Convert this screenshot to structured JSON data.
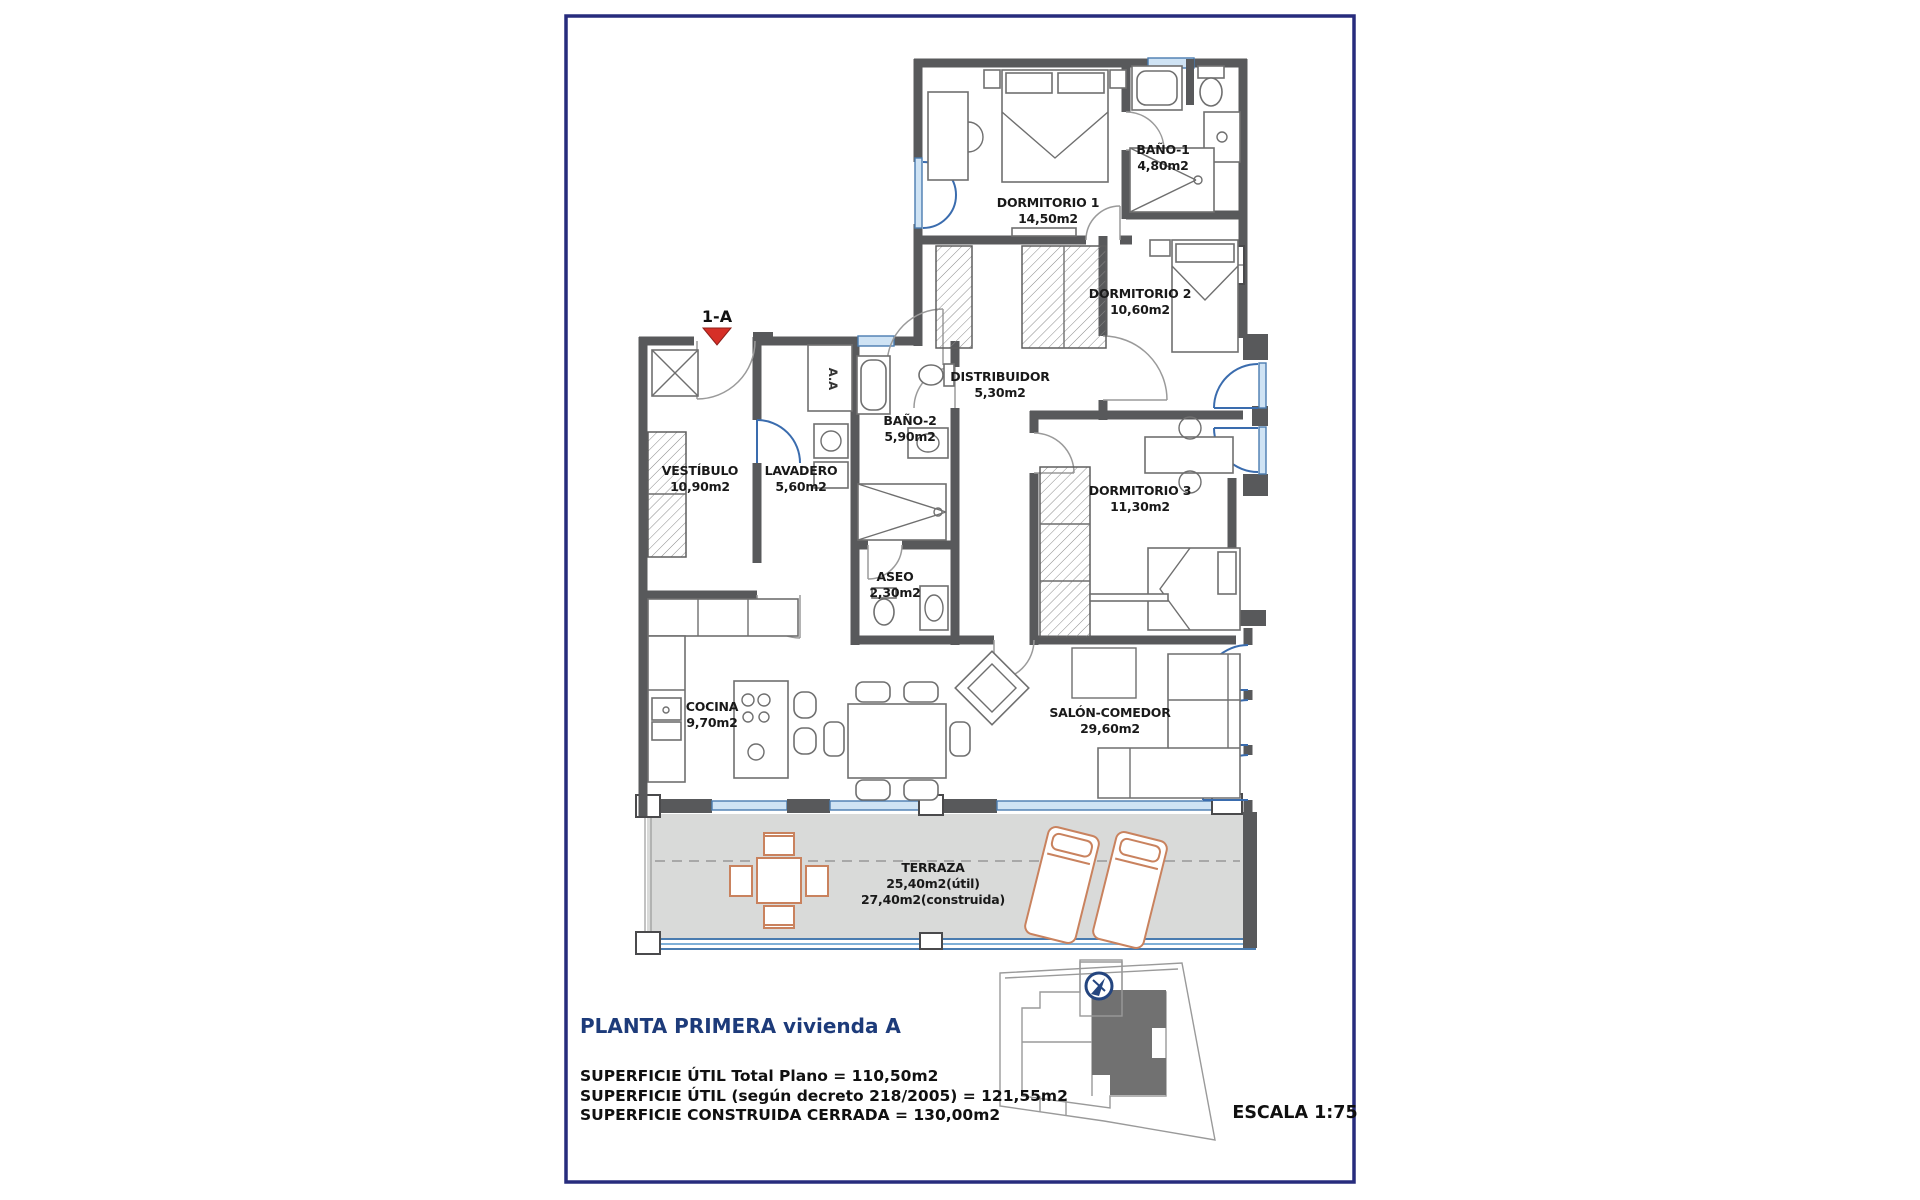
{
  "plan": {
    "unit_marker": "1-A",
    "ac_unit_label": "A.A",
    "rooms": [
      {
        "id": "dormitorio-1",
        "name": "DORMITORIO 1",
        "area": "14,50m2"
      },
      {
        "id": "bano-1",
        "name": "BAÑO-1",
        "area": "4,80m2"
      },
      {
        "id": "dormitorio-2",
        "name": "DORMITORIO 2",
        "area": "10,60m2"
      },
      {
        "id": "distribuidor",
        "name": "DISTRIBUIDOR",
        "area": "5,30m2"
      },
      {
        "id": "bano-2",
        "name": "BAÑO-2",
        "area": "5,90m2"
      },
      {
        "id": "vestibulo",
        "name": "VESTÍBULO",
        "area": "10,90m2"
      },
      {
        "id": "lavadero",
        "name": "LAVADERO",
        "area": "5,60m2"
      },
      {
        "id": "dormitorio-3",
        "name": "DORMITORIO 3",
        "area": "11,30m2"
      },
      {
        "id": "aseo",
        "name": "ASEO",
        "area": "2,30m2"
      },
      {
        "id": "cocina",
        "name": "COCINA",
        "area": "9,70m2"
      },
      {
        "id": "salon-comedor",
        "name": "SALÓN-COMEDOR",
        "area": "29,60m2"
      },
      {
        "id": "terraza",
        "name": "TERRAZA",
        "area_util": "25,40m2(útil)",
        "area_construida": "27,40m2(construida)"
      }
    ]
  },
  "footer": {
    "title": "PLANTA PRIMERA vivienda A",
    "superficie_lines": [
      "SUPERFICIE ÚTIL Total Plano = 110,50m2",
      "SUPERFICIE ÚTIL (según decreto 218/2005) = 121,55m2",
      "SUPERFICIE CONSTRUIDA CERRADA = 130,00m2"
    ],
    "escala": "ESCALA 1:75"
  },
  "colors": {
    "wall": "#58595b",
    "frame": "#272c7d",
    "accent_blue": "#3a6cae",
    "terrace_fill": "#d9dad9",
    "marker_red": "#d62f27",
    "furniture_orange": "#c9825e",
    "footer_navy": "#1d3b7a"
  }
}
